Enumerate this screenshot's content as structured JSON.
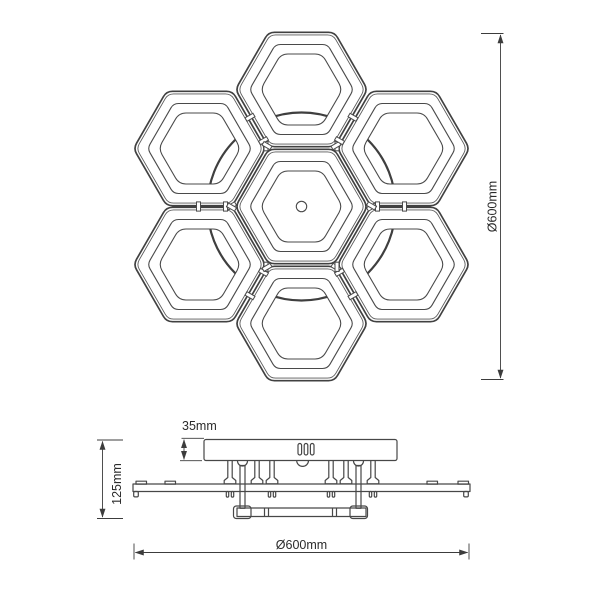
{
  "document": {
    "type": "technical-dimension-drawing",
    "subject": "hexagonal 7-module LED ceiling lamp",
    "background_color": "#ffffff",
    "line_color": "#4a4a4a",
    "dimension_color": "#3c3c3c",
    "text_color": "#2b2b2b"
  },
  "top_view": {
    "module_count": 7,
    "diameter_label": "Ø600mm"
  },
  "side_view": {
    "canopy_height_label": "35mm",
    "fixture_height_label": "125mm",
    "diameter_label": "Ø600mm"
  }
}
